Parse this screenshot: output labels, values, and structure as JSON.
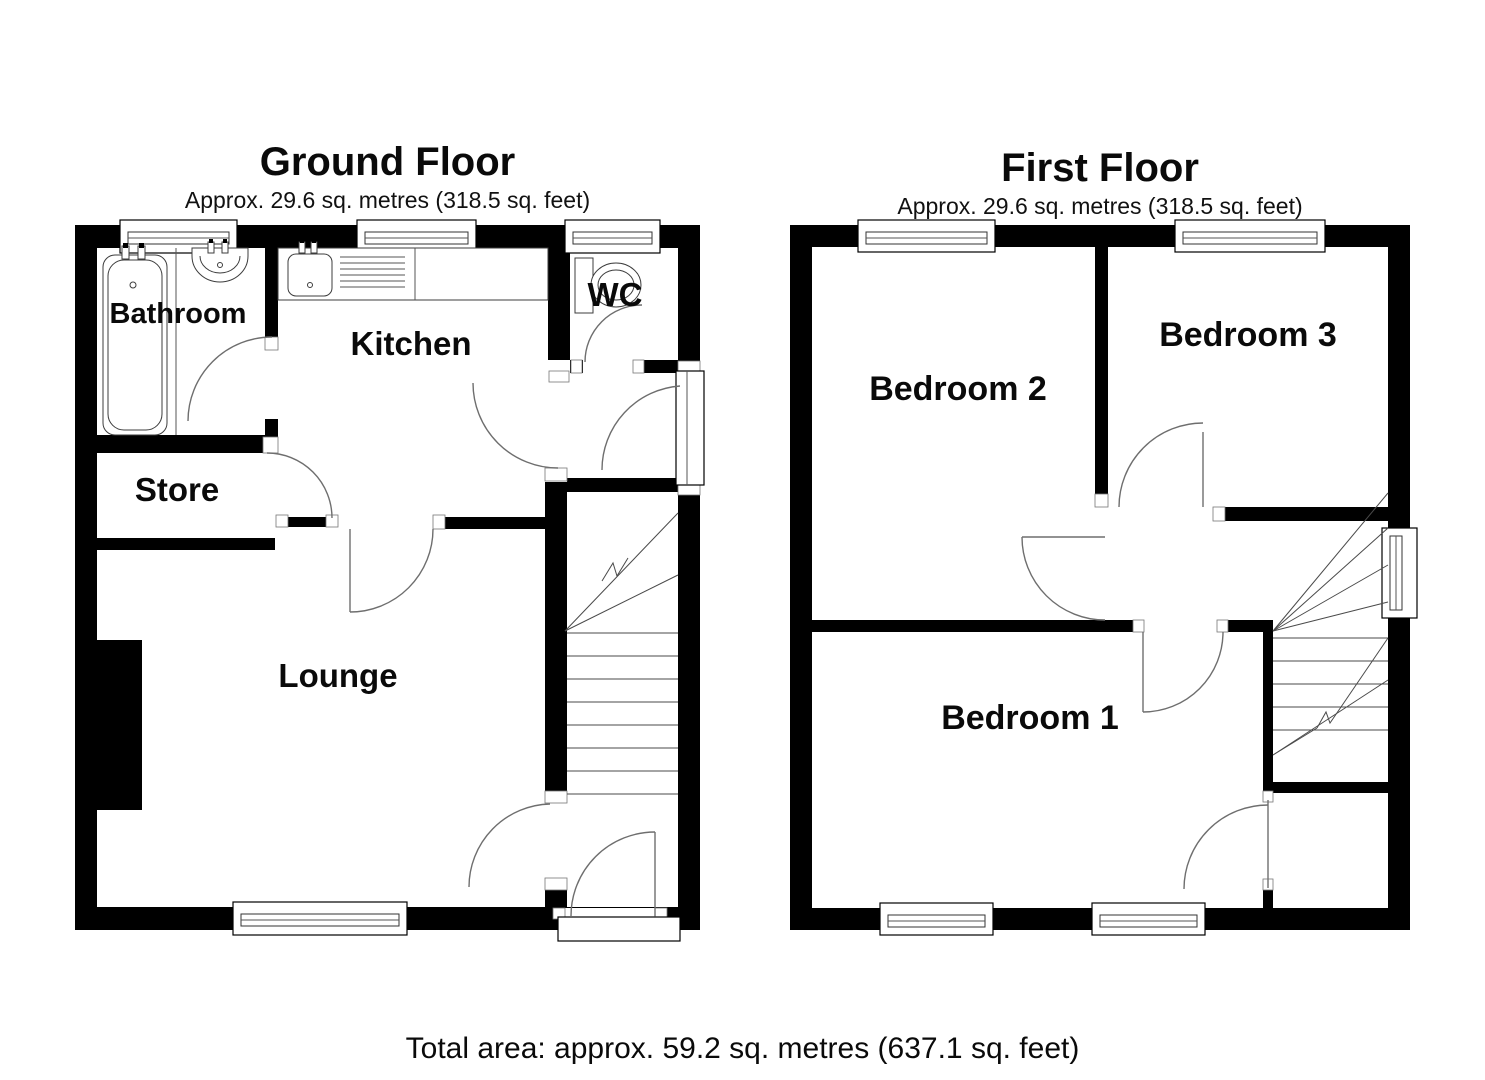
{
  "ground_floor": {
    "title": "Ground Floor",
    "subtitle": "Approx. 29.6 sq. metres (318.5 sq. feet)",
    "rooms": {
      "bathroom": "Bathroom",
      "kitchen": "Kitchen",
      "wc": "WC",
      "store": "Store",
      "lounge": "Lounge"
    }
  },
  "first_floor": {
    "title": "First Floor",
    "subtitle": "Approx. 29.6 sq. metres (318.5 sq. feet)",
    "rooms": {
      "bedroom1": "Bedroom 1",
      "bedroom2": "Bedroom 2",
      "bedroom3": "Bedroom 3"
    }
  },
  "footer": {
    "total_area": "Total area: approx. 59.2 sq. metres (637.1 sq. feet)"
  },
  "colors": {
    "wall": "#000000",
    "background": "#ffffff",
    "line": "#6e6e6e"
  }
}
